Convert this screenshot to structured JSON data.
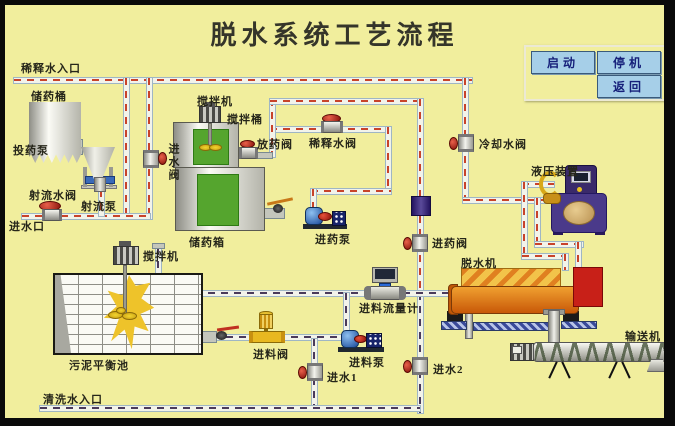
{
  "title": "脱水系统工艺流程",
  "panel": {
    "start": "启动",
    "stop": "停机",
    "back": "返回"
  },
  "labels": {
    "dilution_inlet": "稀释水入口",
    "storage_barrel": "储药桶",
    "dosing_pump": "投药泵",
    "jet_water_valve": "射流水阀",
    "jet_pump": "射流泵",
    "water_inlet_port": "进水口",
    "inlet_valve": "进水阀",
    "mixer_top": "搅拌机",
    "mixing_barrel": "搅拌桶",
    "discharge_valve": "放药阀",
    "dilution_valve": "稀释水阀",
    "chem_tank": "储药箱",
    "chem_pump": "进药泵",
    "cooling_valve": "冷却水阀",
    "hydraulic_unit": "液压装置",
    "chem_inlet_valve": "进药阀",
    "dewaterer": "脱水机",
    "feed_flow_meter": "进料流量计",
    "feed_pump": "进料泵",
    "water1": "进水1",
    "water2": "进水2",
    "pool_mixer": "搅拌机",
    "balance_pool": "污泥平衡池",
    "feed_valve": "进料阀",
    "wash_inlet": "清洗水入口",
    "conveyor": "输送机"
  },
  "colors": {
    "background": "#f1ee9d",
    "water_pipe_dash": "#c8432a",
    "sludge_pipe_dash": "#4a3a5a",
    "button_bg": "#a6cfe8",
    "button_text": "#16207a",
    "dewaterer_body": "#e07818",
    "hydraulic_body": "#4a3a8a",
    "liquid_green": "#55a52e",
    "sludge_yellow": "#eec32a"
  }
}
